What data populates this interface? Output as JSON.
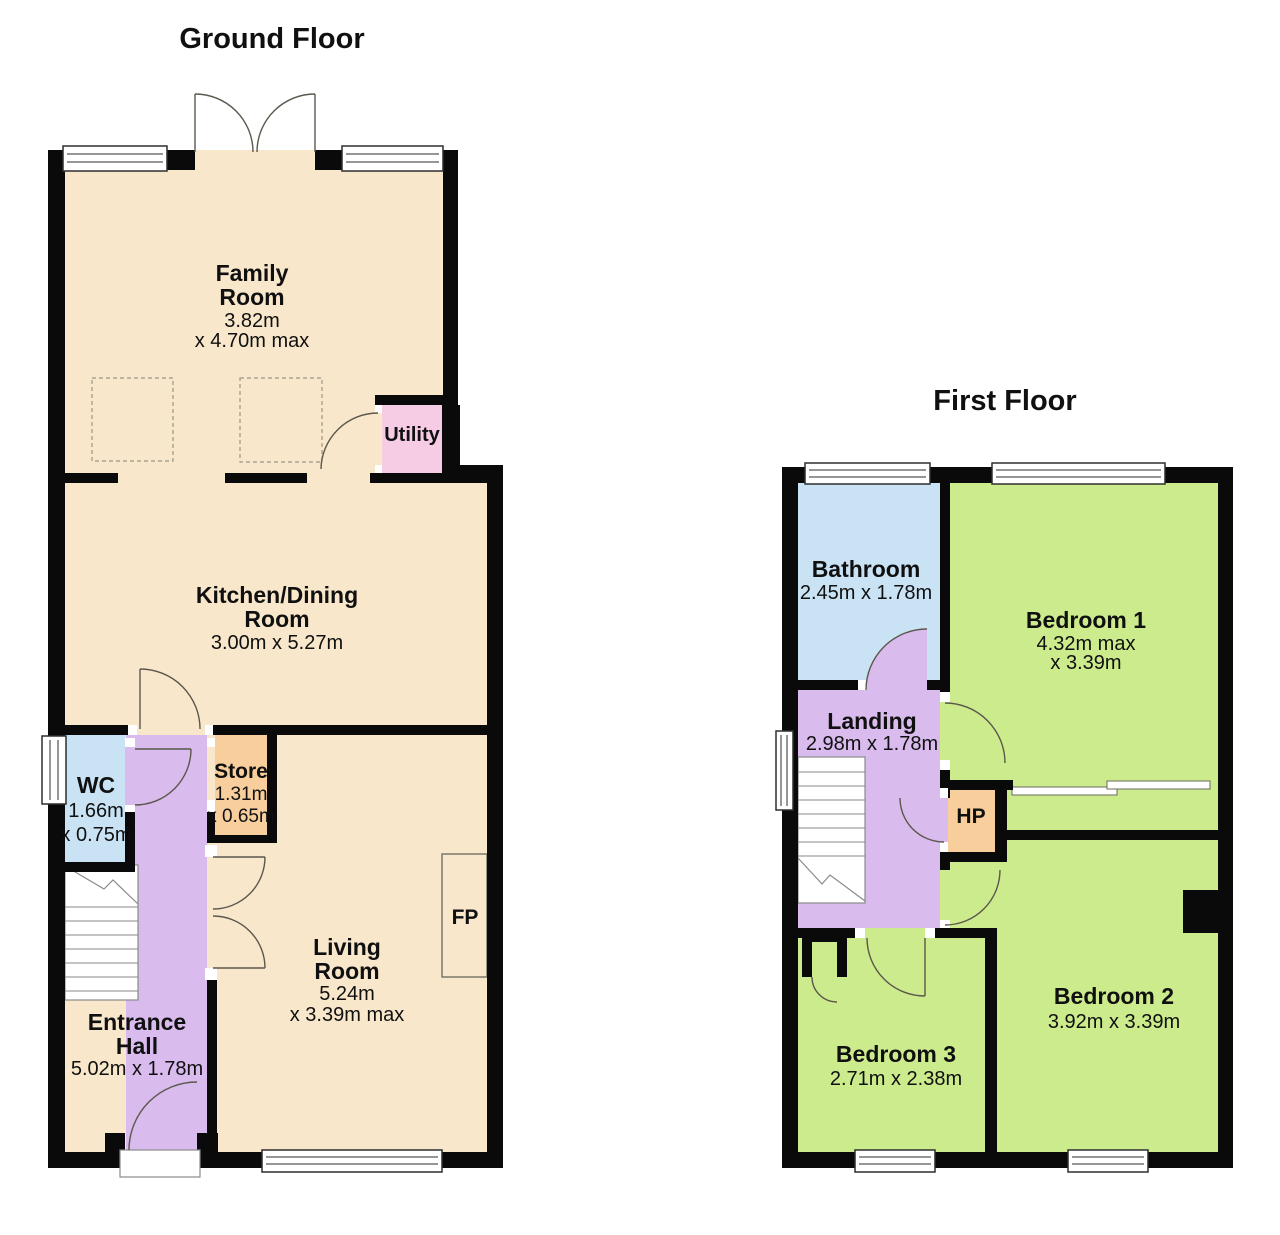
{
  "gf": {
    "title": "Ground Floor",
    "family": [
      "Family",
      "Room",
      "3.82m",
      "x 4.70m max"
    ],
    "kitchen": [
      "Kitchen/Dining",
      "Room",
      "3.00m x 5.27m"
    ],
    "utility": [
      "Utility"
    ],
    "wc": [
      "WC",
      "1.66m",
      "x 0.75m"
    ],
    "store": [
      "Store",
      "1.31m",
      "x 0.65m"
    ],
    "living": [
      "Living",
      "Room",
      "5.24m",
      "x 3.39m max"
    ],
    "hall": [
      "Entrance",
      "Hall",
      "5.02m x 1.78m"
    ],
    "fp": [
      "FP"
    ]
  },
  "ff": {
    "title": "First Floor",
    "bathroom": [
      "Bathroom",
      "2.45m x 1.78m"
    ],
    "bedroom1": [
      "Bedroom 1",
      "4.32m max",
      "x 3.39m"
    ],
    "landing": [
      "Landing",
      "2.98m x 1.78m"
    ],
    "hp": [
      "HP"
    ],
    "bedroom2": [
      "Bedroom 2",
      "3.92m x 3.39m"
    ],
    "bedroom3": [
      "Bedroom 3",
      "2.71m x 2.38m"
    ]
  },
  "colors": {
    "room_cream": "#F8E7CB",
    "room_pink": "#F6CBE4",
    "room_blue": "#C9E3F5",
    "room_purple": "#D9BBEE",
    "room_green": "#CCEB8C",
    "room_orange": "#F7CE9C",
    "wall": "#0A0A0A"
  }
}
